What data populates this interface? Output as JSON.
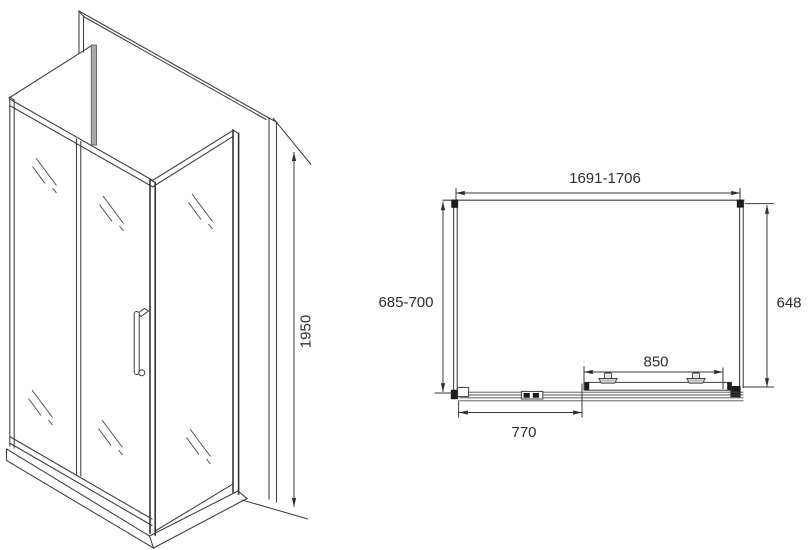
{
  "drawing": {
    "dimensions": {
      "height": "1950",
      "total_width": "1691-1706",
      "total_depth": "685-700",
      "side_width": "648",
      "door_width": "850",
      "fixed_panel_width": "770"
    },
    "colors": {
      "line": "#3d3d3d",
      "background": "#ffffff",
      "profile_gray": "#a8a8a8",
      "fill_black": "#1c1c1c"
    }
  }
}
